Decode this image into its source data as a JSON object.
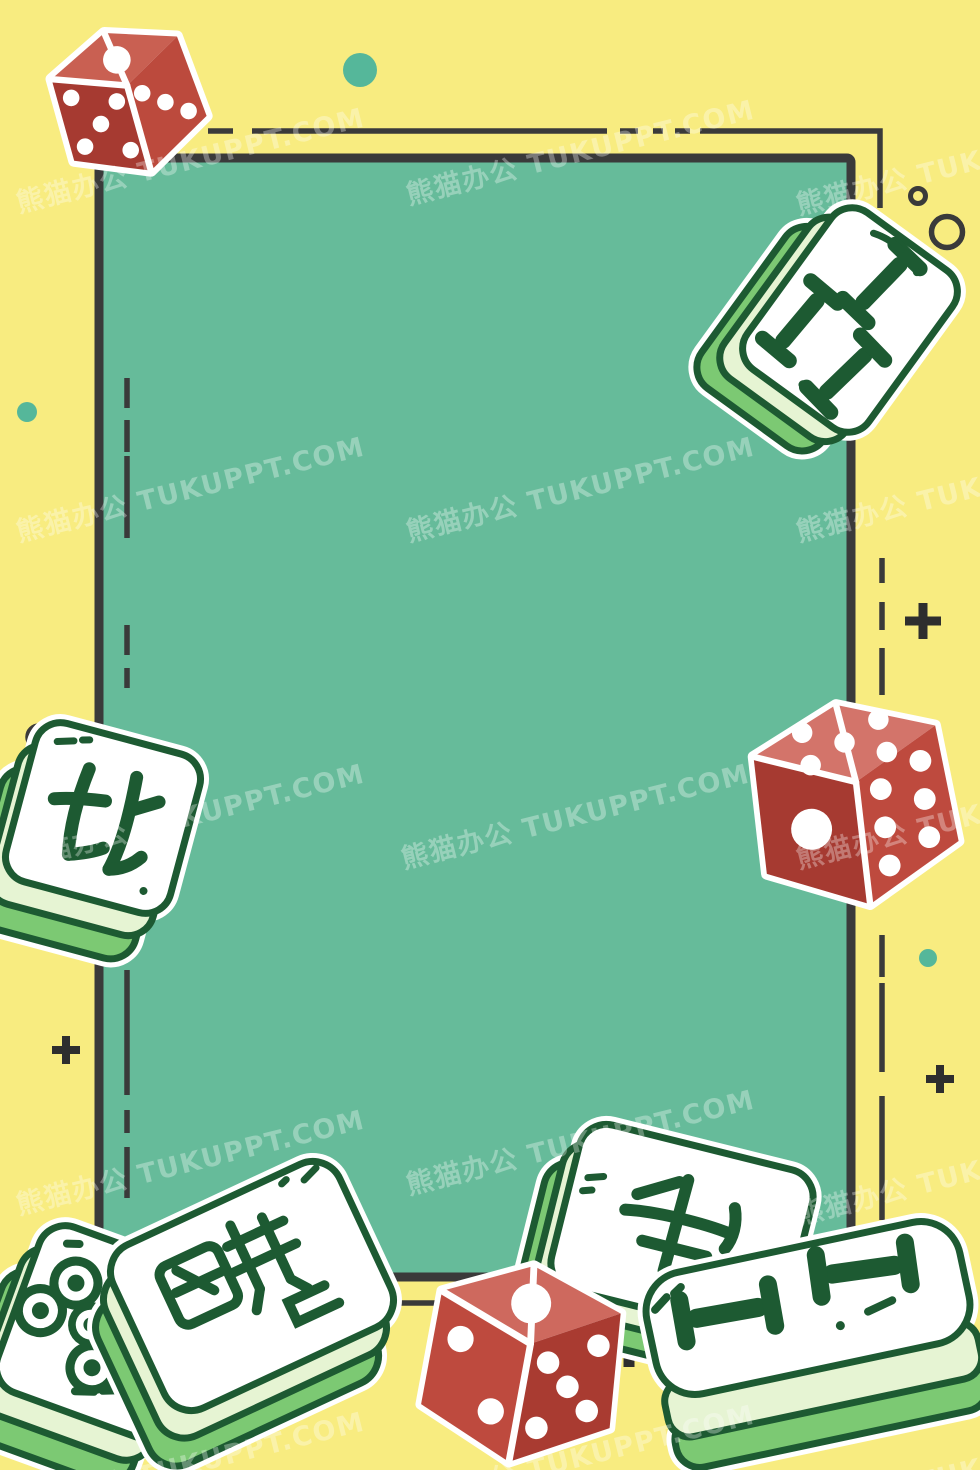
{
  "title": "Cartoon mahjong and dice poster background",
  "watermark": {
    "text": "熊猫办公 TUKUPPT.COM",
    "brand_cn": "熊猫办公",
    "brand_site": "TUKUPPT.COM",
    "instances": [
      {
        "x": 190,
        "y": 158
      },
      {
        "x": 580,
        "y": 150
      },
      {
        "x": 970,
        "y": 160
      },
      {
        "x": 190,
        "y": 487
      },
      {
        "x": 580,
        "y": 487
      },
      {
        "x": 970,
        "y": 487
      },
      {
        "x": 190,
        "y": 814
      },
      {
        "x": 575,
        "y": 814
      },
      {
        "x": 970,
        "y": 814
      },
      {
        "x": 190,
        "y": 1160
      },
      {
        "x": 580,
        "y": 1140
      },
      {
        "x": 970,
        "y": 1170
      },
      {
        "x": 190,
        "y": 1462
      },
      {
        "x": 580,
        "y": 1455
      },
      {
        "x": 970,
        "y": 1468
      }
    ]
  },
  "palette": {
    "background_yellow": "#F8EC80",
    "panel_green": "#66BB9A",
    "line_dark": "#3A3A3A",
    "tile_outline_green": "#1D5A32",
    "tile_face": "#FFFFFF",
    "tile_side_light": "#E6F4D3",
    "tile_side_green": "#7CC973",
    "die_red_dark": "#A63A31",
    "die_red_mid": "#BE4A3E",
    "die_red_light": "#D3746A",
    "pip_white": "#FFFFFF",
    "accent_teal_dot": "#55B79A"
  },
  "tiles": [
    {
      "id": "north-wind",
      "suit": "honor",
      "character": "北",
      "meaning": "North wind",
      "location": "middle-left"
    },
    {
      "id": "three-bamboo",
      "suit": "bamboo",
      "value": 3,
      "location": "top-right"
    },
    {
      "id": "five-circles",
      "suit": "circles",
      "value": 5,
      "location": "bottom-left"
    },
    {
      "id": "character-front-left",
      "suit": "character",
      "character": "stylized hand-drawn character",
      "location": "bottom-left"
    },
    {
      "id": "character-back-right",
      "suit": "character",
      "character": "stylized hand-drawn character",
      "location": "bottom-right-back"
    },
    {
      "id": "two-bamboo",
      "suit": "bamboo",
      "value": 2,
      "location": "bottom-right-front"
    }
  ],
  "dice": [
    {
      "id": "die-top-left",
      "visible_faces": [
        1,
        5,
        3
      ]
    },
    {
      "id": "die-middle-right",
      "visible_faces": [
        1,
        5,
        6
      ]
    },
    {
      "id": "die-bottom-center",
      "visible_faces": [
        1,
        2,
        5
      ]
    }
  ],
  "decorations": {
    "plus_signs": 4,
    "teal_dots": 3,
    "outline_circles": 3
  }
}
